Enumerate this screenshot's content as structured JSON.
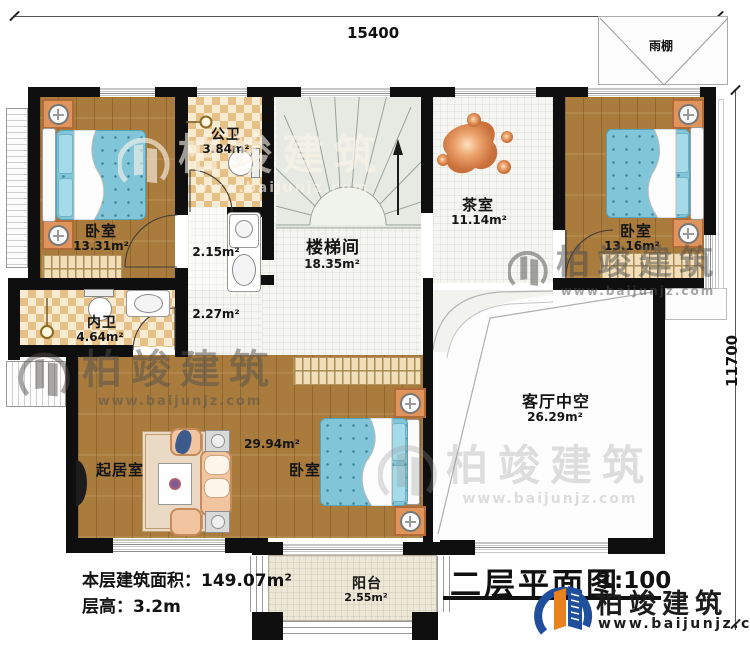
{
  "dimensions": {
    "top": "15400",
    "right": "11700"
  },
  "title": {
    "text": "二层平面图",
    "scale": "1:100"
  },
  "stats": {
    "area_line": "本层建筑面积：149.07m²",
    "height_line": "层高：3.2m"
  },
  "brand": {
    "name": "柏竣建筑",
    "url": "www.baijunjz.com"
  },
  "rooms": {
    "bedroom1": {
      "name": "卧室",
      "area": "13.31m²"
    },
    "public_bath": {
      "name": "公卫",
      "area": "3.84m²"
    },
    "stair_hall": {
      "name": "楼梯间",
      "area": "18.35m²"
    },
    "tea_room": {
      "name": "茶室",
      "area": "11.14m²"
    },
    "bedroom2": {
      "name": "卧室",
      "area": "13.16m²"
    },
    "inner_bath": {
      "name": "内卫",
      "area": "4.64m²"
    },
    "living_room": {
      "name": "起居室"
    },
    "bedroom3": {
      "name": "卧室",
      "area": "29.94m²"
    },
    "void": {
      "name": "客厅中空",
      "area": "26.29m²"
    },
    "balcony": {
      "name": "阳台",
      "area": "2.55m²"
    },
    "canopy": {
      "name": "雨棚"
    },
    "bath_lobby": {
      "area": "2.15m²"
    },
    "hallway": {
      "area": "2.27m²"
    }
  },
  "colors": {
    "wall": "#0f0f0f",
    "wood": "#a97c3e",
    "mattress": "#80c5d8",
    "brand_blue": "#1e4e9c",
    "brand_orange": "#e8821e"
  }
}
